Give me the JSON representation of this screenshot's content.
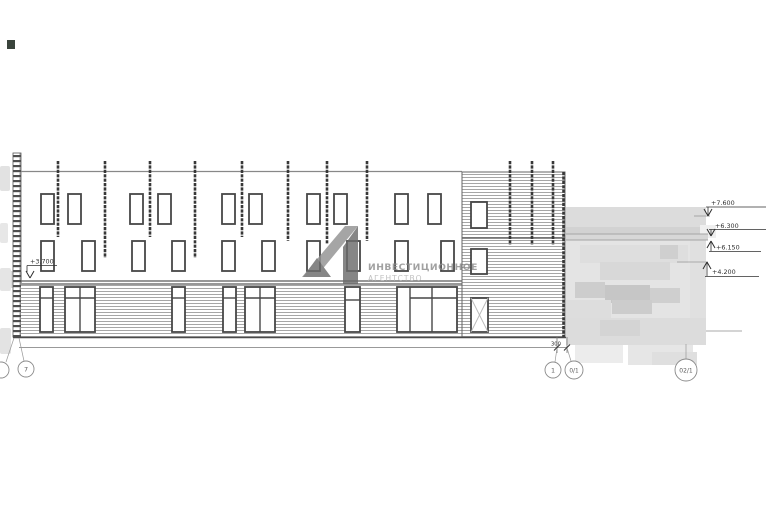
{
  "drawing": {
    "left_level": "+3.700",
    "levels": {
      "l1": "+7.600",
      "l2": "+6.300",
      "l3": "+6.150",
      "l4": "+4.200"
    },
    "dim_300": "300",
    "axes": {
      "left": "7",
      "r1": "1",
      "r2": "0/1",
      "r3": "02/1"
    }
  },
  "watermark": {
    "line1": "ИНВЕСТИЦИОННОЕ",
    "line2": "АГЕНТСТВО"
  },
  "colors": {
    "frame": "#474747",
    "fin": "#383838",
    "stripe": "#a6a6a6",
    "watermark_dark": "#6c6c6c",
    "watermark_light": "#929292",
    "redaction_base": "#e4e4e4"
  }
}
